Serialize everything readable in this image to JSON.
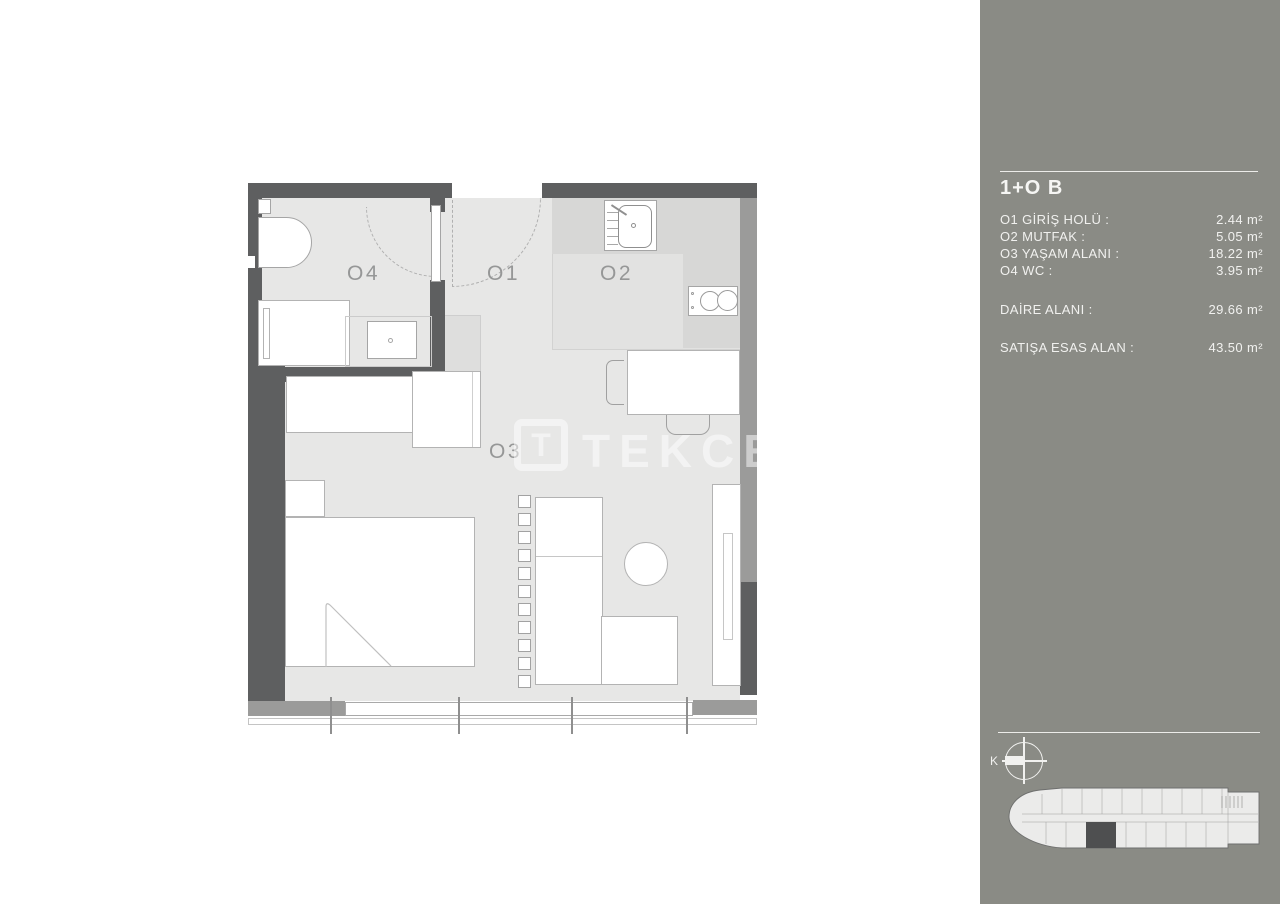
{
  "sidebar": {
    "title": "1+O B",
    "rooms": [
      {
        "label": "O1 GİRİŞ HOLÜ :",
        "value": "2.44 m²"
      },
      {
        "label": "O2 MUTFAK :",
        "value": "5.05 m²"
      },
      {
        "label": "O3 YAŞAM ALANI :",
        "value": "18.22 m²"
      },
      {
        "label": "O4 WC :",
        "value": "3.95 m²"
      }
    ],
    "summary": [
      {
        "label": "DAİRE ALANI :",
        "value": "29.66 m²"
      },
      {
        "label": "SATIŞA ESAS ALAN :",
        "value": "43.50 m²"
      }
    ],
    "compass_label": "K"
  },
  "plan": {
    "room_labels": {
      "o1": "O1",
      "o2": "O2",
      "o3": "O3",
      "o4": "O4"
    },
    "watermark": {
      "logo_letter": "T",
      "text": "TEKCE"
    }
  },
  "colors": {
    "sidebar_bg": "#8a8b85",
    "wall_dark": "#5e5f60",
    "wall_medium": "#9b9b9a",
    "floor": "#e7e7e6",
    "kitchen_floor": "#e2e2e1",
    "counter": "#d7d7d6",
    "sidebar_text": "#f1f1ef",
    "room_label_text": "#969797"
  }
}
